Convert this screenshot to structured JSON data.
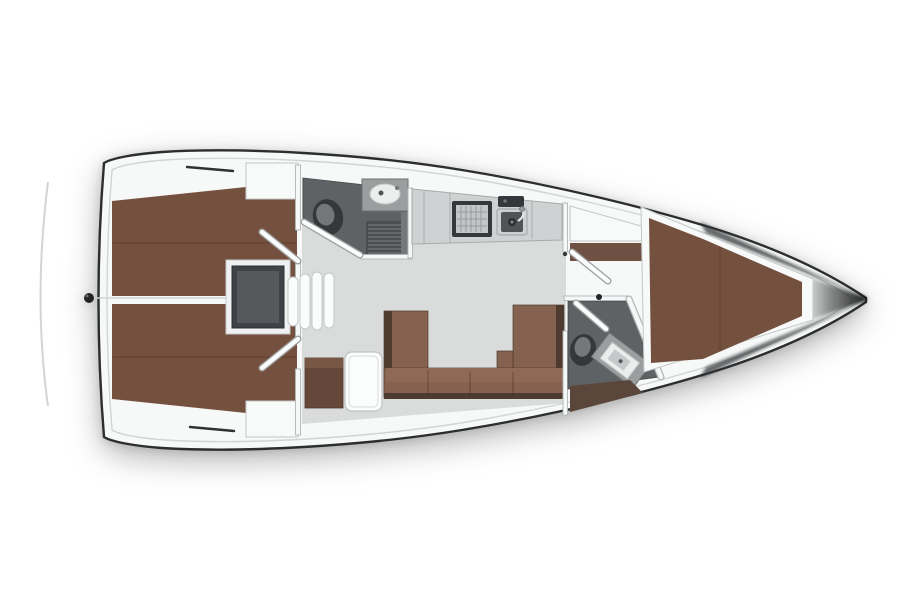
{
  "canvas": {
    "width": 900,
    "height": 600,
    "background": "#ffffff"
  },
  "figure": {
    "type": "floorplan",
    "subject": "sailing-yacht-interior-top-view",
    "orientation": {
      "bow": "right",
      "stern": "left"
    }
  },
  "colors": {
    "hull": "#f7f8f8",
    "hull_outline": "#2b2d2e",
    "rail": "#d2d5d5",
    "floor": "#dadcdc",
    "berth": "#74513f",
    "berth_shade": "#5f4638",
    "settee": "#85614f",
    "settee_light": "#8f6956",
    "settee_dark": "#4e3a2f",
    "cabinet": "#66483a",
    "cabinet_top": "#785745",
    "shelf": "#6f5042",
    "shelf_shadow": "#5a463a",
    "head_floor": "#5f6264",
    "grate": "#4b4e50",
    "grate_line": "#7f8284",
    "engine": "#3f4347",
    "engine_inner": "#55595c",
    "engine_frame": "#f0f1f2",
    "fixture_dark": "#35383a",
    "fixture_mid": "#75787a",
    "steel": "#9b9e9f",
    "steel_light": "#cdd0d0",
    "basin": "#515456",
    "porcelain": "#eceeee",
    "counter": "#cfd1d2",
    "counter_edge": "#a8abab",
    "wall": "#f6f7f7",
    "wall_edge": "#b2b5b5",
    "door": "#fbfcfc",
    "door_edge": "#9da0a0",
    "white_box": "#f8f9f9",
    "box_edge": "#c5c8c8",
    "hatch": "#2f3133",
    "fitting": "#222426",
    "shadow_deep": "#141516"
  },
  "rooms": [
    {
      "id": "aft-cabin-port",
      "fixtures": [
        "double-berth",
        "locker",
        "door"
      ]
    },
    {
      "id": "aft-cabin-starboard",
      "fixtures": [
        "double-berth",
        "locker",
        "door"
      ]
    },
    {
      "id": "aft-head",
      "fixtures": [
        "toilet",
        "washbasin",
        "shower-grate",
        "door"
      ]
    },
    {
      "id": "galley",
      "fixtures": [
        "stove",
        "sink",
        "counter",
        "fridge"
      ]
    },
    {
      "id": "salon",
      "fixtures": [
        "u-settee",
        "table",
        "side-cabinet",
        "companionway-steps",
        "engine-compartment"
      ]
    },
    {
      "id": "forward-head",
      "fixtures": [
        "toilet",
        "vanity-sink",
        "door"
      ]
    },
    {
      "id": "forward-cabin",
      "fixtures": [
        "v-berth",
        "locker",
        "side-shelves",
        "door"
      ]
    }
  ],
  "exterior": [
    "hull-outline",
    "toe-rail",
    "transom-arc",
    "stern-fitting",
    "deck-hatch-port",
    "deck-hatch-starboard",
    "bow-shadow"
  ]
}
